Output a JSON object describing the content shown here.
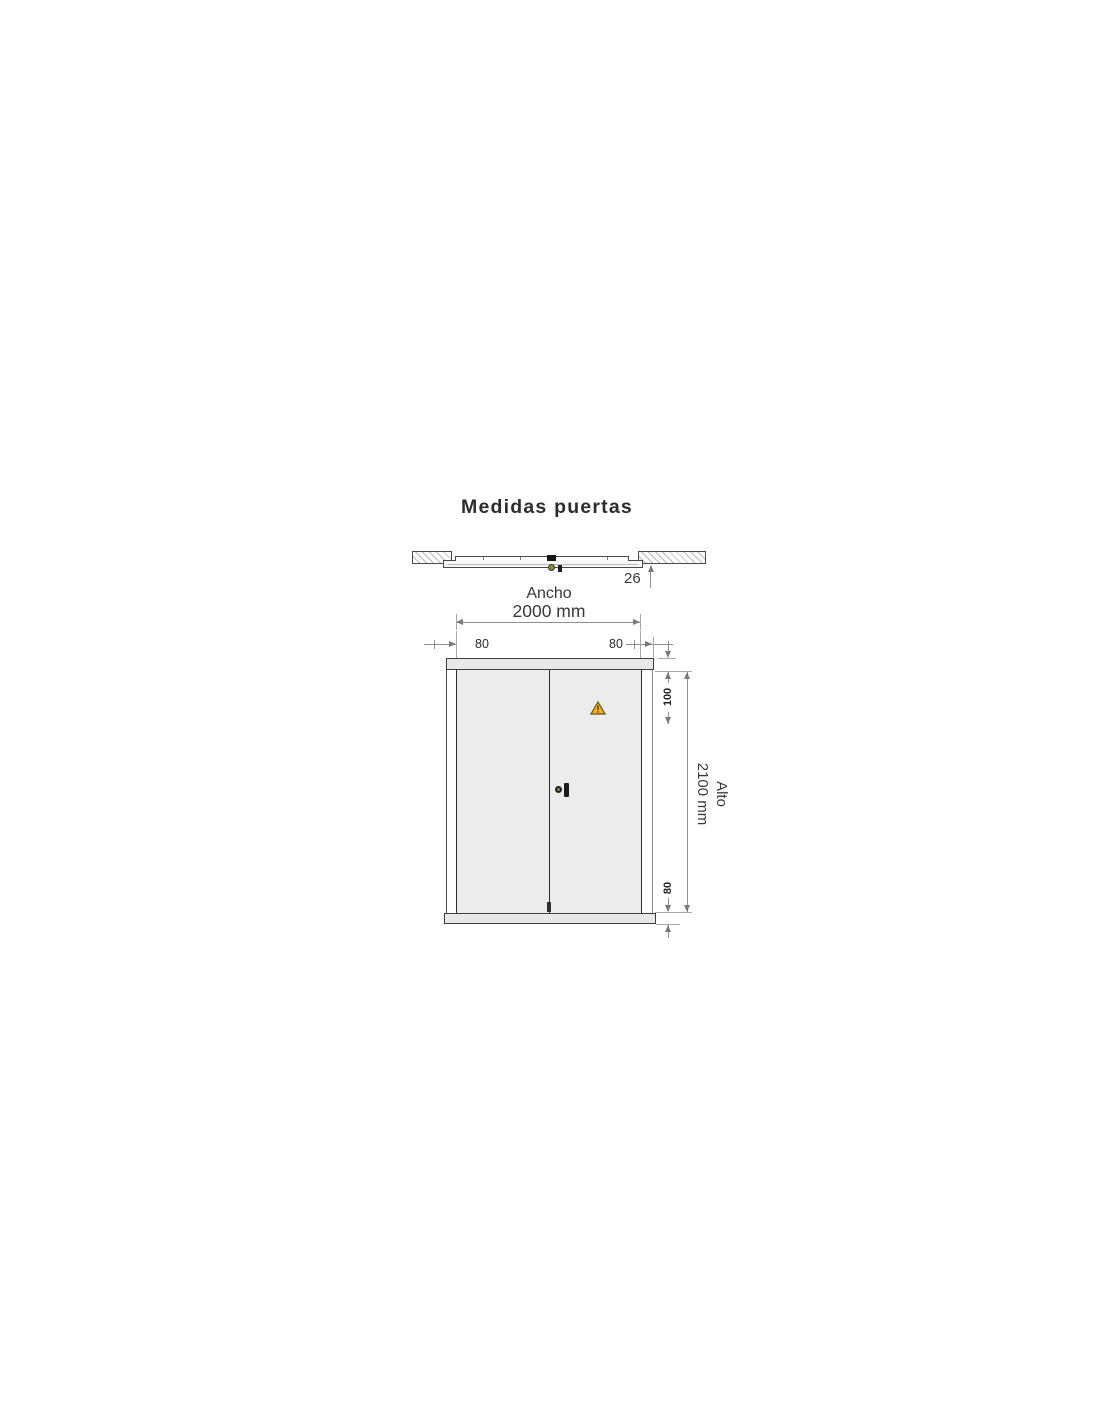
{
  "title": "Medidas puertas",
  "topview": {
    "thickness": "26"
  },
  "width": {
    "label": "Ancho",
    "value": "2000 mm",
    "left_frame": "80",
    "right_frame": "80"
  },
  "height": {
    "label": "Alto",
    "value": "2100 mm",
    "top_rail": "100",
    "bottom_rail": "80"
  },
  "icons": {
    "warning": "warning-triangle-icon"
  },
  "colors": {
    "background": "#ffffff",
    "door_leaf": "#ececec",
    "door_rail": "#e8e8e8",
    "outline_dark": "#2e2e2e",
    "dimension_line": "#8f8f8f",
    "hatch": "#b9b9b9",
    "warning_fill": "#f2b32b",
    "warning_border": "#6a5200",
    "text": "#2b2b2b"
  }
}
